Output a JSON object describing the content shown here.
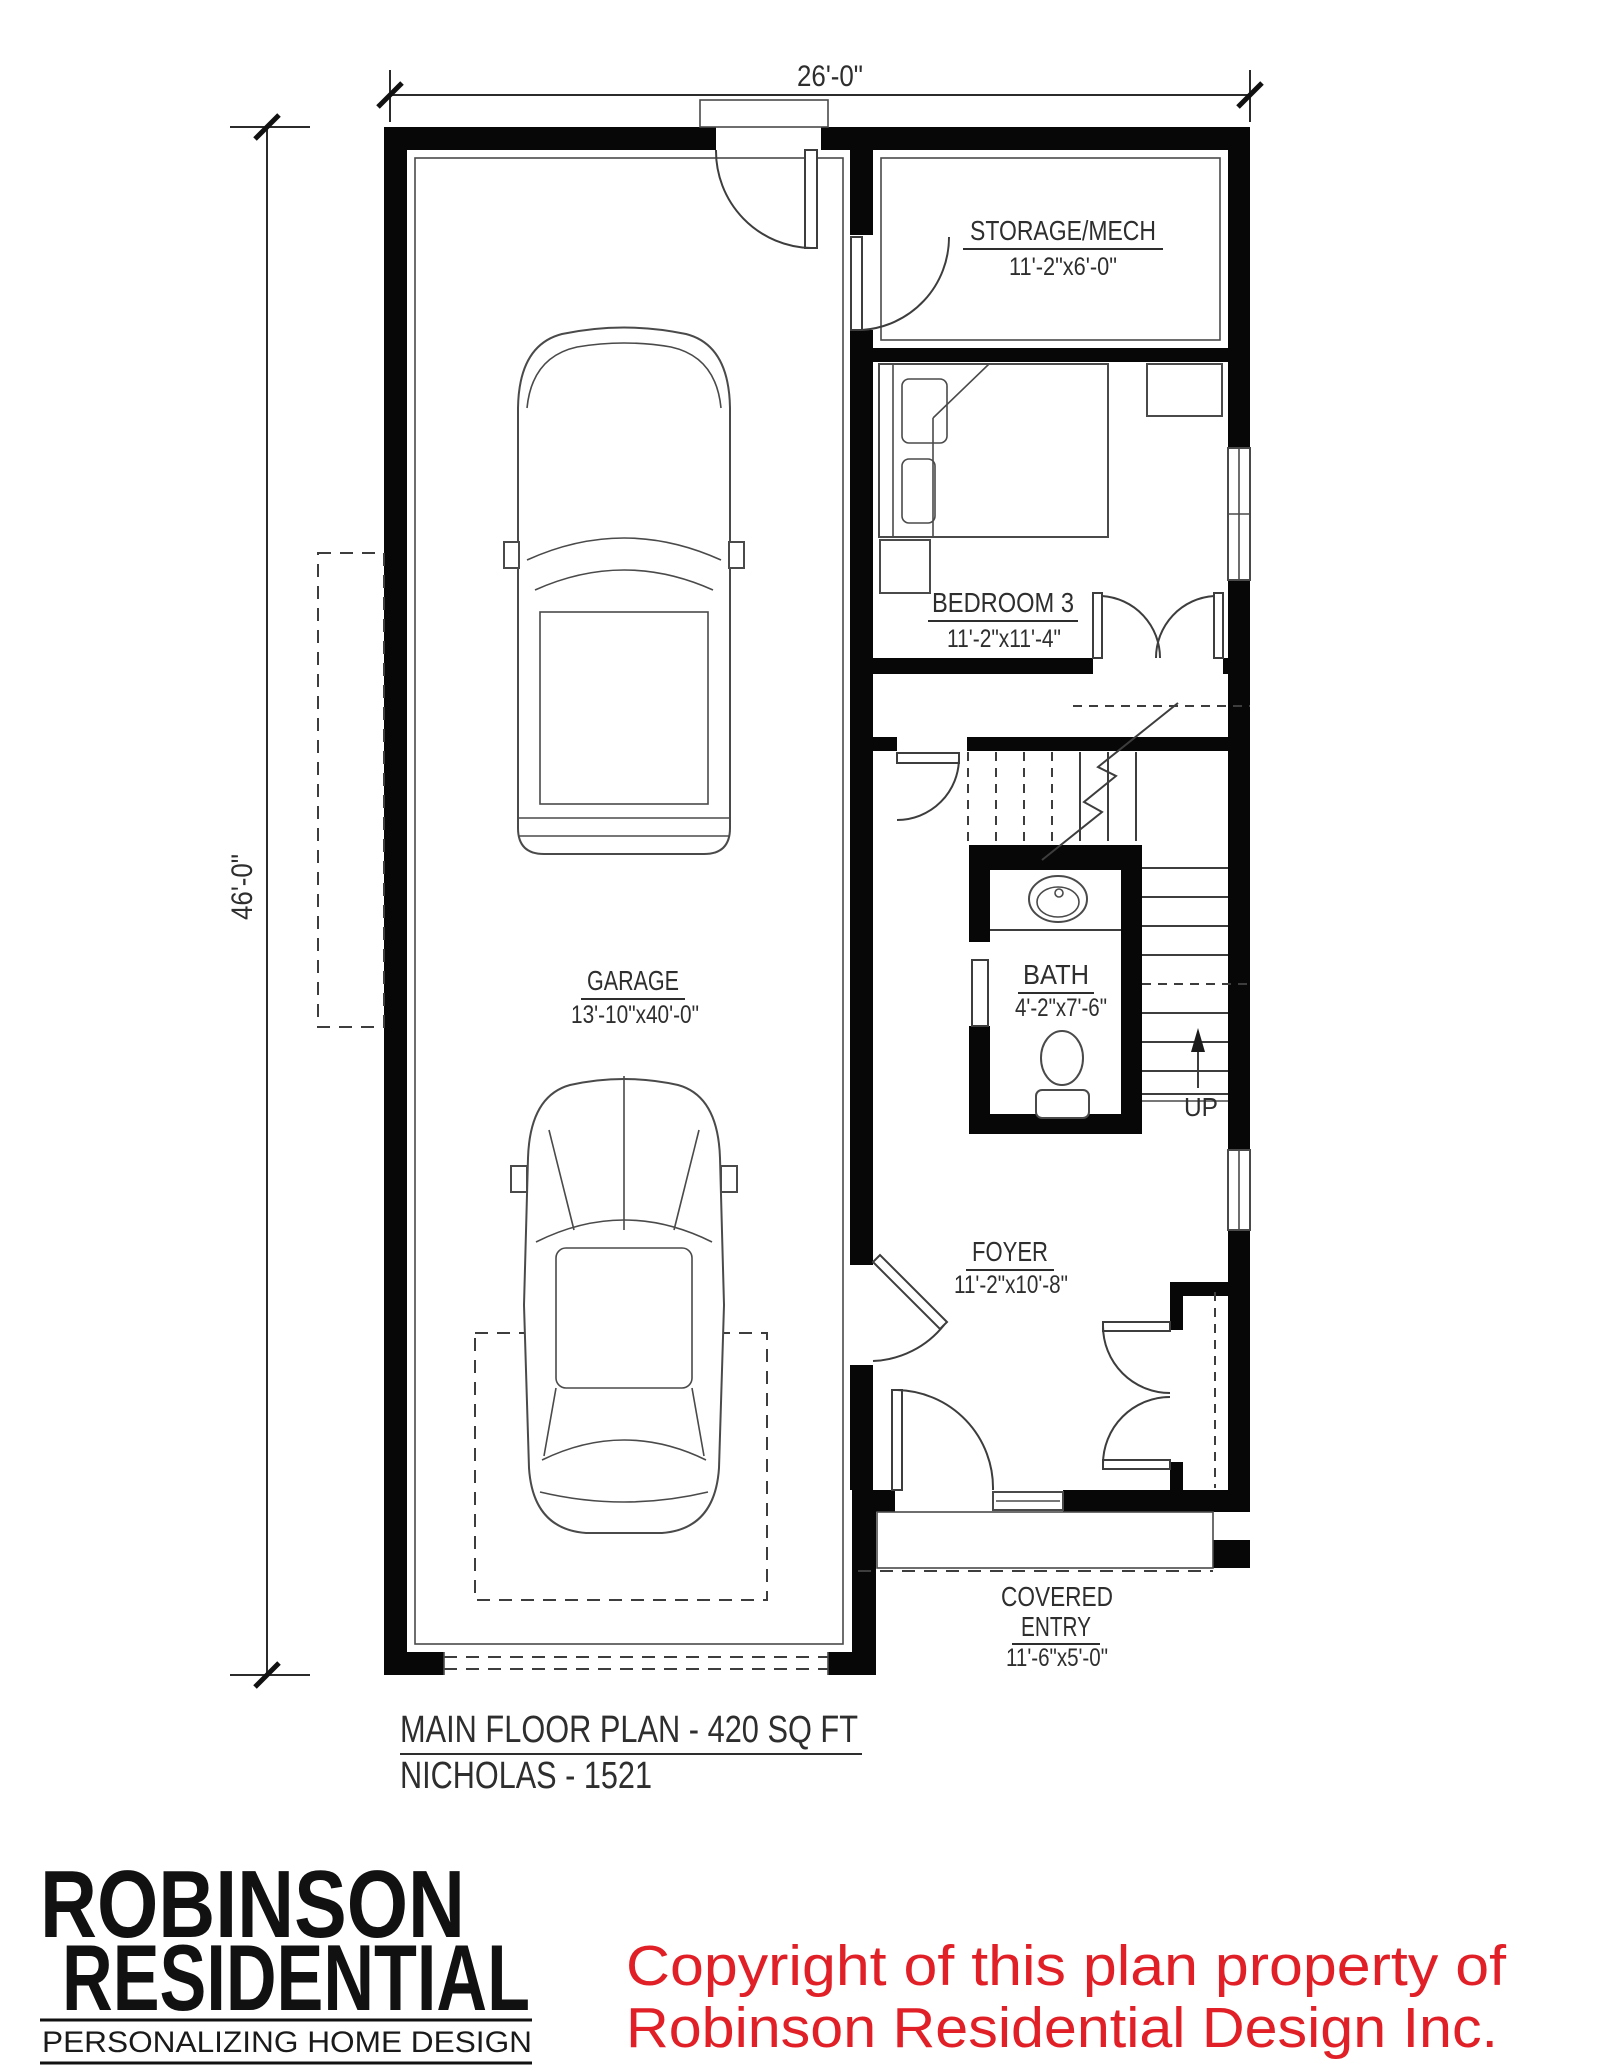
{
  "plan": {
    "dimensions": {
      "width": "26'-0\"",
      "height": "46'-0\""
    },
    "rooms": {
      "storage": {
        "name": "STORAGE/MECH",
        "size": "11'-2\"x6'-0\""
      },
      "bedroom": {
        "name": "BEDROOM 3",
        "size": "11'-2\"x11'-4\""
      },
      "garage": {
        "name": "GARAGE",
        "size": "13'-10\"x40'-0\""
      },
      "bath": {
        "name": "BATH",
        "size": "4'-2\"x7'-6\""
      },
      "foyer": {
        "name": "FOYER",
        "size": "11'-2\"x10'-8\""
      },
      "covered_entry": {
        "name_line1": "COVERED",
        "name_line2": "ENTRY",
        "size": "11'-6\"x5'-0\""
      }
    },
    "stairs": {
      "direction": "UP"
    },
    "title": {
      "line1": "MAIN FLOOR PLAN - 420 SQ FT",
      "line2": "NICHOLAS - 1521"
    }
  },
  "branding": {
    "logo_line1": "ROBINSON",
    "logo_line2": "RESIDENTIAL",
    "tagline": "PERSONALIZING HOME DESIGN"
  },
  "copyright": {
    "line1": "Copyright of this plan property of",
    "line2": "Robinson Residential Design Inc.",
    "color": "#e01f26"
  },
  "colors": {
    "wall": "#070707",
    "line": "#3d3d3d",
    "accent_red": "#e01f26"
  }
}
